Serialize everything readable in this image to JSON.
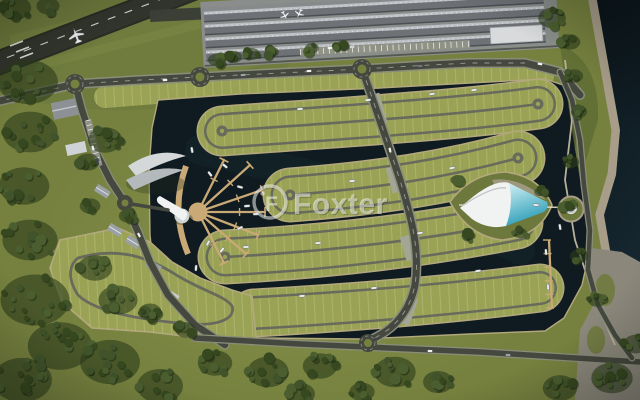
{
  "image_type": "aerial-masterplan-render",
  "watermark": {
    "text": "Foxter",
    "logo": "foxter-ring-icon",
    "logo_glyph": "F"
  },
  "palette": {
    "grass": "#76813f",
    "grassLight": "#8d974e",
    "grassDark": "#66713a",
    "forestShadow": "#2c3c1b",
    "water": "#0f1b20",
    "seaTop": "#0a141a",
    "seaBot": "#16262e",
    "plot": "#9aa355",
    "plotLine": "#cbc98e",
    "loopRoad": "#686b5c",
    "road": "#45483e",
    "roadEdge": "#8a8d7a",
    "runway": "#33362d",
    "apron": "#8b8e8f",
    "hangar": "#6e7176",
    "hangarRidge": "#bcc0c4",
    "dock": "#c9a975",
    "seawall": "#b3a87d",
    "sand": "#a79d89",
    "rough": "#8b877b",
    "poolLight": "#cfeef2",
    "poolDeep": "#38a7c0",
    "whiteBld": "#f1f3f3",
    "islandGreen": "#6d783c",
    "boat": "#e9ecec"
  },
  "scene": {
    "tree_clusters": [
      [
        15,
        8,
        14,
        7
      ],
      [
        48,
        6,
        10,
        5
      ],
      [
        28,
        82,
        26,
        12
      ],
      [
        30,
        132,
        24,
        12
      ],
      [
        24,
        186,
        22,
        11
      ],
      [
        30,
        240,
        24,
        12
      ],
      [
        105,
        140,
        15,
        8
      ],
      [
        88,
        162,
        10,
        5
      ],
      [
        90,
        206,
        9,
        5
      ],
      [
        128,
        216,
        8,
        5
      ],
      [
        95,
        268,
        15,
        8
      ],
      [
        118,
        300,
        17,
        9
      ],
      [
        35,
        300,
        30,
        16
      ],
      [
        60,
        346,
        28,
        14
      ],
      [
        22,
        380,
        26,
        13
      ],
      [
        110,
        362,
        26,
        13
      ],
      [
        160,
        386,
        20,
        10
      ],
      [
        150,
        312,
        10,
        6
      ],
      [
        186,
        330,
        9,
        5
      ],
      [
        215,
        363,
        15,
        8
      ],
      [
        268,
        372,
        18,
        9
      ],
      [
        320,
        366,
        15,
        8
      ],
      [
        395,
        372,
        18,
        9
      ],
      [
        438,
        382,
        13,
        7
      ],
      [
        300,
        394,
        13,
        7
      ],
      [
        362,
        392,
        11,
        6
      ],
      [
        560,
        388,
        15,
        8
      ],
      [
        612,
        378,
        18,
        10
      ],
      [
        636,
        344,
        11,
        6
      ],
      [
        552,
        18,
        12,
        7
      ],
      [
        570,
        42,
        9,
        5
      ],
      [
        216,
        60,
        7,
        4
      ],
      [
        234,
        57,
        7,
        4
      ],
      [
        252,
        54,
        7,
        4
      ],
      [
        272,
        52,
        6,
        3
      ],
      [
        312,
        48,
        6,
        3
      ],
      [
        342,
        46,
        6,
        3
      ],
      [
        574,
        76,
        8,
        5
      ],
      [
        579,
        112,
        7,
        4
      ],
      [
        571,
        162,
        7,
        4
      ],
      [
        567,
        206,
        6,
        4
      ],
      [
        579,
        256,
        8,
        5
      ],
      [
        597,
        300,
        8,
        5
      ],
      [
        456,
        180,
        5,
        3
      ],
      [
        540,
        192,
        5,
        3
      ],
      [
        520,
        233,
        6,
        3
      ],
      [
        470,
        236,
        5,
        3
      ]
    ],
    "boats": [
      [
        300,
        109,
        -5
      ],
      [
        368,
        100,
        -6
      ],
      [
        432,
        94,
        -8
      ],
      [
        474,
        90,
        -8
      ],
      [
        352,
        181,
        -4
      ],
      [
        452,
        168,
        -10
      ],
      [
        246,
        247,
        -3
      ],
      [
        318,
        243,
        -4
      ],
      [
        420,
        233,
        -8
      ],
      [
        302,
        296,
        -4
      ],
      [
        374,
        288,
        -5
      ],
      [
        478,
        271,
        -8
      ],
      [
        546,
        252,
        85
      ],
      [
        548,
        287,
        85
      ],
      [
        536,
        205,
        5
      ],
      [
        560,
        227,
        80
      ],
      [
        225,
        166,
        40
      ],
      [
        240,
        187,
        15
      ],
      [
        247,
        206,
        -5
      ],
      [
        240,
        228,
        -25
      ],
      [
        222,
        250,
        -50
      ],
      [
        210,
        174,
        52
      ],
      [
        208,
        243,
        -62
      ],
      [
        256,
        214,
        -4
      ],
      [
        192,
        150,
        80
      ],
      [
        196,
        268,
        95
      ]
    ],
    "cars": [
      [
        165,
        80,
        -4,
        "#f2f2f2"
      ],
      [
        243,
        75,
        -3,
        "#9aa2aa"
      ],
      [
        309,
        71,
        -3,
        "#f2f2f2"
      ],
      [
        420,
        66,
        -2,
        "#6d7780"
      ],
      [
        390,
        150,
        78,
        "#f2f2f2"
      ],
      [
        93,
        148,
        72,
        "#f2f2f2"
      ],
      [
        97,
        161,
        72,
        "#39444c"
      ],
      [
        139,
        235,
        62,
        "#f2f2f2"
      ],
      [
        430,
        351,
        2,
        "#f2f2f2"
      ],
      [
        508,
        355,
        3,
        "#9aa2aa"
      ],
      [
        330,
        48,
        -3,
        "#f2f2f2"
      ],
      [
        352,
        47,
        -3,
        "#cfd4d8"
      ],
      [
        540,
        64,
        10,
        "#f2f2f2"
      ]
    ],
    "planes": [
      [
        76,
        35,
        -20,
        1.3
      ],
      [
        285,
        16,
        150,
        0.8
      ],
      [
        299,
        14,
        205,
        0.8
      ]
    ],
    "dock_hub": [
      198,
      212
    ],
    "dock_arms": [
      [
        250,
        165
      ],
      [
        262,
        190
      ],
      [
        265,
        212
      ],
      [
        258,
        235
      ],
      [
        246,
        254
      ],
      [
        224,
        263
      ],
      [
        224,
        160
      ]
    ],
    "east_dock": {
      "x1": 549,
      "y1": 240,
      "x2": 552,
      "y2": 308,
      "tees": 5
    }
  }
}
